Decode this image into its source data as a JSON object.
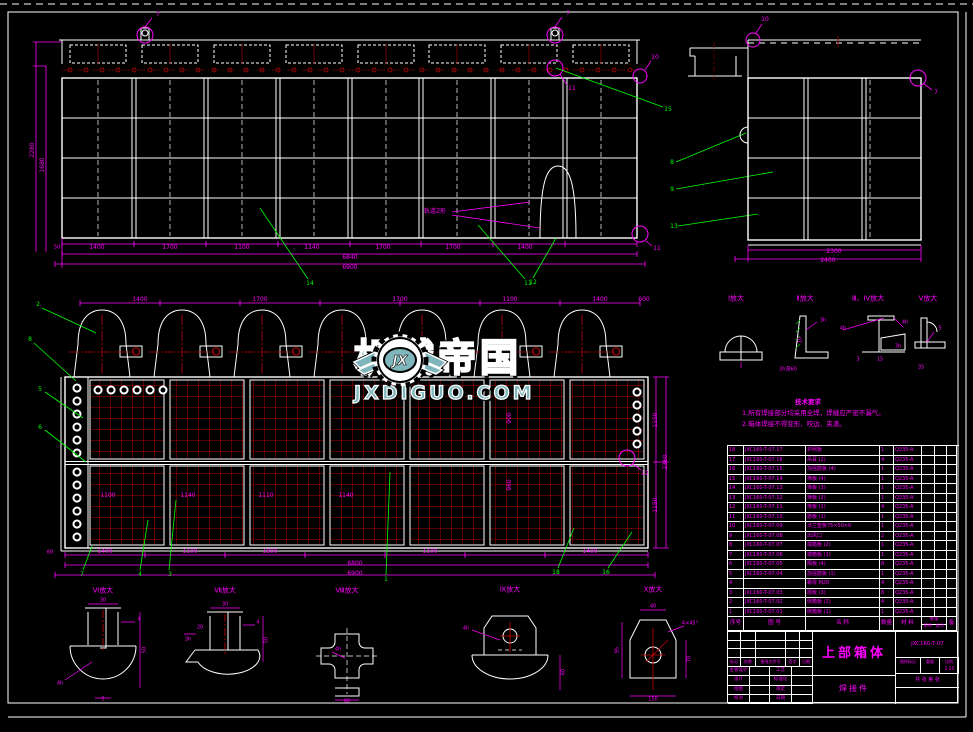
{
  "watermark": {
    "logo_initials": "JX",
    "brand": "机械帝国",
    "site": "JXDIGUO.COM"
  },
  "colors": {
    "background": "#000000",
    "line_white": "#FFFFFF",
    "dim_magenta": "#FF00FF",
    "leader_green": "#00FF00",
    "mesh_red": "#C00000",
    "centerline_red": "#8B0000",
    "watermark_teal": "#7FB6BC"
  },
  "front_view": {
    "dim_height_outer": "2280",
    "dim_height_inner": "1680",
    "dim_small_left": "50",
    "dims_bottom": [
      "1400",
      "1700",
      "1100",
      "1140",
      "1700",
      "1700",
      "1400"
    ],
    "dim_total_inner": "6840",
    "dim_total_outer": "6900",
    "callout_left": "14",
    "callout_mid": "11",
    "callout_right": "12",
    "callouts_right_column": [
      "15",
      "8",
      "9",
      "13"
    ],
    "flag_lug_left": "7",
    "flag_lug_right": "7",
    "flag_below_lug": "11",
    "flag_corner_top": "10",
    "flag_corner_bottom": "11",
    "annotation": "轨道Z形"
  },
  "side_view": {
    "dim_inner": "2300",
    "dim_outer": "2400",
    "flag_top_left": "10",
    "flag_top_right": "7"
  },
  "plan_view": {
    "dims_top": [
      "1400",
      "1700",
      "1700",
      "1100",
      "1400",
      "600"
    ],
    "dims_bottom": [
      "60",
      "1400",
      "1100",
      "1800",
      "1100",
      "1400"
    ],
    "dim_total_inner": "6800",
    "dim_total_outer": "6900",
    "dims_right": [
      "1150",
      "1150",
      "2360"
    ],
    "dims_inner_row1": [
      "900",
      "960"
    ],
    "dims_inner_row2": [
      "1100",
      "1140",
      "1110",
      "1140"
    ],
    "callouts_left": [
      "2",
      "8",
      "5",
      "6"
    ],
    "callouts_bottom": [
      "7",
      "4",
      "3",
      "1",
      "18",
      "16"
    ],
    "flag_detail": "12"
  },
  "details_right": {
    "captions": [
      "Ⅰ放大",
      "Ⅱ放大",
      "Ⅲ、Ⅳ放大",
      "Ⅴ放大"
    ],
    "notes": [
      "3h",
      "10",
      "3h深60",
      "4h",
      "3",
      "15",
      "4h",
      "3h",
      "5",
      "35"
    ]
  },
  "tech_req": {
    "title": "技术要求",
    "line1": "1.所有焊接部分均采用全焊，焊缝应严密不漏气。",
    "line2": "2.箱体焊接不得变形、咬边、夹渣。"
  },
  "bom": {
    "headers": {
      "no": "序号",
      "code": "图 号",
      "name": "名 称",
      "qty": "数量",
      "mat": "材 料",
      "weight": "重量",
      "unit": "单件",
      "total": "总计",
      "remark": "备 注"
    },
    "rows": [
      {
        "no": "18",
        "code": "JXC160-T-07.17",
        "name": "护网板",
        "qty": "1",
        "mat": "Q235-A"
      },
      {
        "no": "17",
        "code": "JXC160-T-07.16",
        "name": "吊耳 (2)",
        "qty": "4",
        "mat": "Q235-A"
      },
      {
        "no": "16",
        "code": "JXC160-T-07.15",
        "name": "加强筋板 (4)",
        "qty": "1",
        "mat": "Q235-A"
      },
      {
        "no": "15",
        "code": "JXC160-T-07.14",
        "name": "筛板 (4)",
        "qty": "1",
        "mat": "Q235-A"
      },
      {
        "no": "14",
        "code": "JXC160-T-07.13",
        "name": "筛板 (3)",
        "qty": "1",
        "mat": "Q235-A"
      },
      {
        "no": "13",
        "code": "JXC160-T-07.12",
        "name": "筛板 (2)",
        "qty": "1",
        "mat": "Q235-A"
      },
      {
        "no": "12",
        "code": "JXC160-T-07.11",
        "name": "筛板 (1)",
        "qty": "4",
        "mat": "Q235-A"
      },
      {
        "no": "11",
        "code": "JXC160-T-07.10",
        "name": "筋板 (1)",
        "qty": "1",
        "mat": "Q235-A"
      },
      {
        "no": "10",
        "code": "JXC160-T-07.09",
        "name": "法兰垫板75×50×6",
        "qty": "1",
        "mat": "Q235-A"
      },
      {
        "no": "9",
        "code": "JXC160-T-07.08",
        "name": "出风口",
        "qty": "2",
        "mat": "Q235-A"
      },
      {
        "no": "8",
        "code": "JXC160-T-07.07",
        "name": "端箱板 (2)",
        "qty": "1",
        "mat": "Q235-A"
      },
      {
        "no": "7",
        "code": "JXC160-T-07.06",
        "name": "端箱板 (1)",
        "qty": "1",
        "mat": "Q235-A"
      },
      {
        "no": "6",
        "code": "JXC160-T-07.05",
        "name": "隔板 (4)",
        "qty": "8",
        "mat": "Q235-A"
      },
      {
        "no": "5",
        "code": "JXC160-T-07.04",
        "name": "加强筋板 (1)",
        "qty": "1",
        "mat": "Q235-A"
      },
      {
        "no": "4",
        "code": "",
        "name": "螺母 M20",
        "qty": "4",
        "mat": "Q235-A"
      },
      {
        "no": "3",
        "code": "JXC160-T-07.03",
        "name": "隔板 (3)",
        "qty": "8",
        "mat": "Q235-A"
      },
      {
        "no": "2",
        "code": "JXC160-T-07.02",
        "name": "侧箱板 (2)",
        "qty": "4",
        "mat": "Q235-A"
      },
      {
        "no": "1",
        "code": "JXC160-T-07.01",
        "name": "侧箱板 (1)",
        "qty": "1",
        "mat": "Q235-A"
      }
    ]
  },
  "title_block": {
    "title": "上部箱体",
    "drawing_no": "JXC160-T-07",
    "type_label": "焊接件",
    "rev_headers": [
      "标记",
      "处数",
      "更改文件号",
      "签字",
      "日期"
    ],
    "roles_left": [
      "主管设计",
      "设计",
      "绘图",
      "校对"
    ],
    "roles_right": [
      "工艺",
      "标准化",
      "审定",
      "日期"
    ],
    "stamp_headers": [
      "图样标记",
      "重量",
      "比例"
    ],
    "scale": "1:25",
    "sheet_note": "共 张 第 张"
  },
  "details_bottom": {
    "captions": [
      "Ⅵ放大",
      "Ⅶ放大",
      "Ⅷ放大",
      "Ⅸ放大",
      "Ⅹ放大"
    ],
    "dims_d1": [
      "30",
      "4",
      "50",
      "4h",
      "5"
    ],
    "dims_d2": [
      "30",
      "4",
      "20",
      "3h",
      "50"
    ],
    "dims_d3": [
      "4h",
      "60"
    ],
    "dims_d4": [
      "4h",
      "60"
    ],
    "dims_d5": [
      "40",
      "4×45°",
      "95",
      "70",
      "150"
    ]
  }
}
